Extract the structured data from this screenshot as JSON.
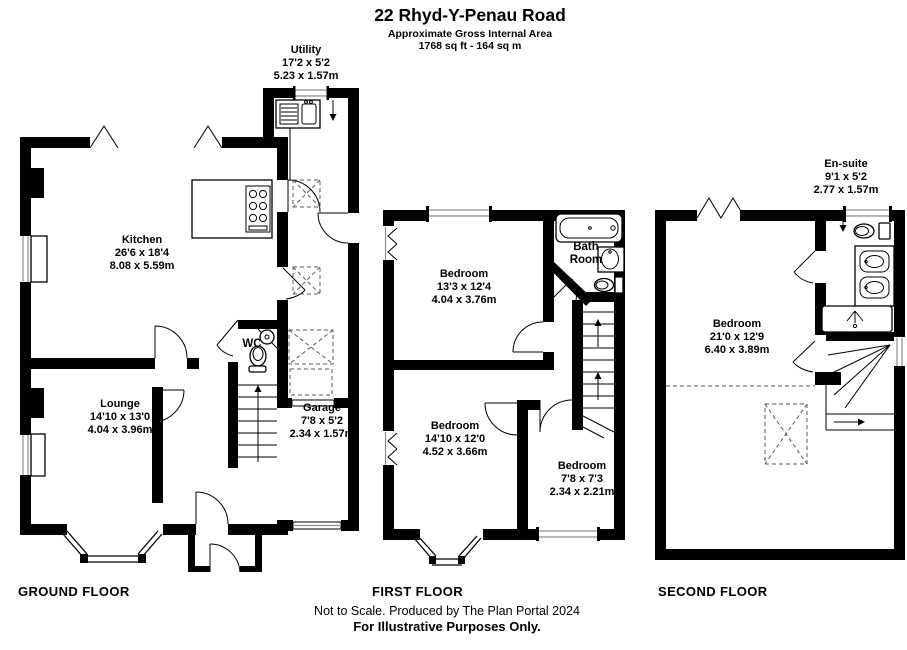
{
  "header": {
    "title": "22 Rhyd-Y-Penau Road",
    "subtitle": "Approximate Gross Internal Area",
    "area": "1768 sq ft - 164 sq m"
  },
  "floors": {
    "ground": {
      "caption": "GROUND FLOOR",
      "utility": {
        "name": "Utility",
        "imperial": "17'2 x 5'2",
        "metric": "5.23 x 1.57m"
      },
      "kitchen": {
        "name": "Kitchen",
        "imperial": "26'6 x 18'4",
        "metric": "8.08 x 5.59m"
      },
      "lounge": {
        "name": "Lounge",
        "imperial": "14'10 x 13'0",
        "metric": "4.04 x 3.96m"
      },
      "wc": {
        "name": "WC"
      },
      "garage": {
        "name": "Garage",
        "imperial": "7'8 x 5'2",
        "metric": "2.34 x 1.57m"
      }
    },
    "first": {
      "caption": "FIRST FLOOR",
      "bedroom1": {
        "name": "Bedroom",
        "imperial": "13'3 x 12'4",
        "metric": "4.04 x 3.76m"
      },
      "bathroom": {
        "line1": "Bath",
        "line2": "Room"
      },
      "bedroom2": {
        "name": "Bedroom",
        "imperial": "14'10 x 12'0",
        "metric": "4.52 x 3.66m"
      },
      "bedroom3": {
        "name": "Bedroom",
        "imperial": "7'8 x 7'3",
        "metric": "2.34 x 2.21m"
      }
    },
    "second": {
      "caption": "SECOND FLOOR",
      "ensuite": {
        "name": "En-suite",
        "imperial": "9'1 x 5'2",
        "metric": "2.77 x 1.57m"
      },
      "bedroom": {
        "name": "Bedroom",
        "imperial": "21'0 x 12'9",
        "metric": "6.40 x 3.89m"
      }
    }
  },
  "footer": {
    "line1": "Not to Scale. Produced by The Plan Portal 2024",
    "line2": "For Illustrative Purposes Only."
  }
}
